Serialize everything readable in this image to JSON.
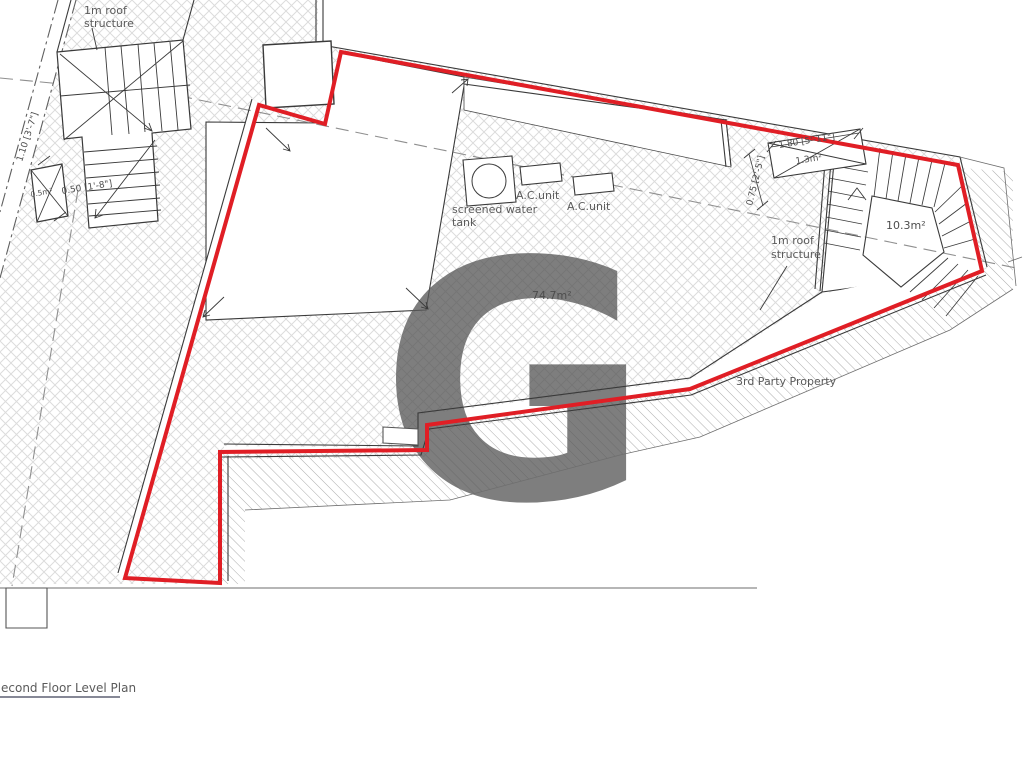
{
  "drawing": {
    "title": "econd Floor Level Plan",
    "watermark_letter": "G",
    "labels": {
      "roof_structure_left": {
        "line1": "1m roof",
        "line2": "structure"
      },
      "roof_structure_right": {
        "line1": "1m roof",
        "line2": "structure"
      },
      "water_tank": {
        "line1": "screened water",
        "line2": "tank"
      },
      "ac_unit_1": "A.C.unit",
      "ac_unit_2": "A.C.unit",
      "third_party": "3rd Party Property"
    },
    "areas": {
      "main_terrace": "74.7m²",
      "stairwell": "10.3m²",
      "void": "1.3m²",
      "shaft": "0.5m²"
    },
    "dimensions": {
      "left_width": "1.10 [3'-7\"]",
      "left_shaft": "0.50 [1'-8\"]",
      "right_depth": "0.75 [2'-5\"]",
      "right_width": "1.80 [5'-11\"]"
    },
    "colors": {
      "boundary_red": "#e01e25",
      "watermark_pink": "#f0b0a6",
      "hatch_gray": "#dcdcdc",
      "third_party_hatch": "#a3a3a3",
      "line_dark": "#3a3a3a",
      "text_gray": "#5a5a5a",
      "title_color": "#3e4257"
    }
  }
}
